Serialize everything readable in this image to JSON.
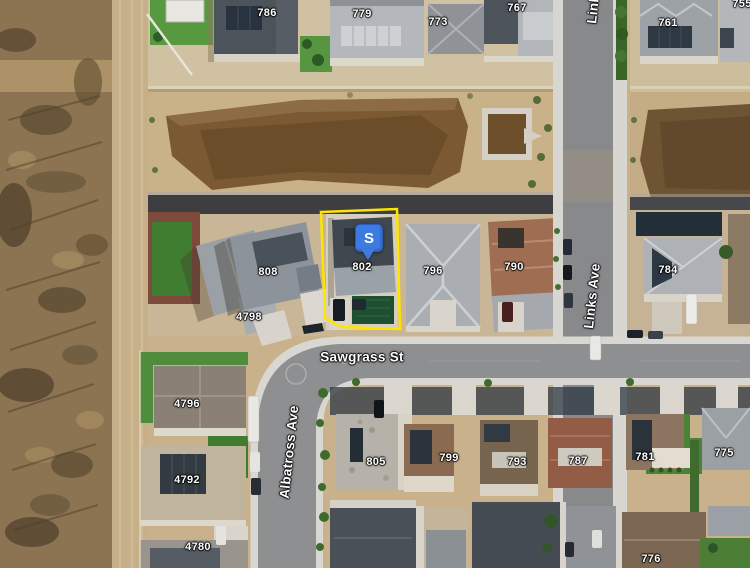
{
  "map": {
    "view": "satellite",
    "streets": {
      "sawgrass": "Sawgrass St",
      "albatross": "Albatross Ave",
      "links": "Links Ave",
      "links_top": "Links Ave"
    },
    "marker": {
      "glyph": "S",
      "fill": "#3d7be0"
    },
    "highlight": {
      "parcel_number": "802",
      "stroke": "#ffe400"
    },
    "house_numbers": [
      "786",
      "779",
      "773",
      "767",
      "761",
      "755",
      "808",
      "802",
      "796",
      "790",
      "784",
      "4798",
      "4796",
      "4792",
      "4780",
      "805",
      "799",
      "793",
      "787",
      "781",
      "775",
      "776"
    ]
  }
}
